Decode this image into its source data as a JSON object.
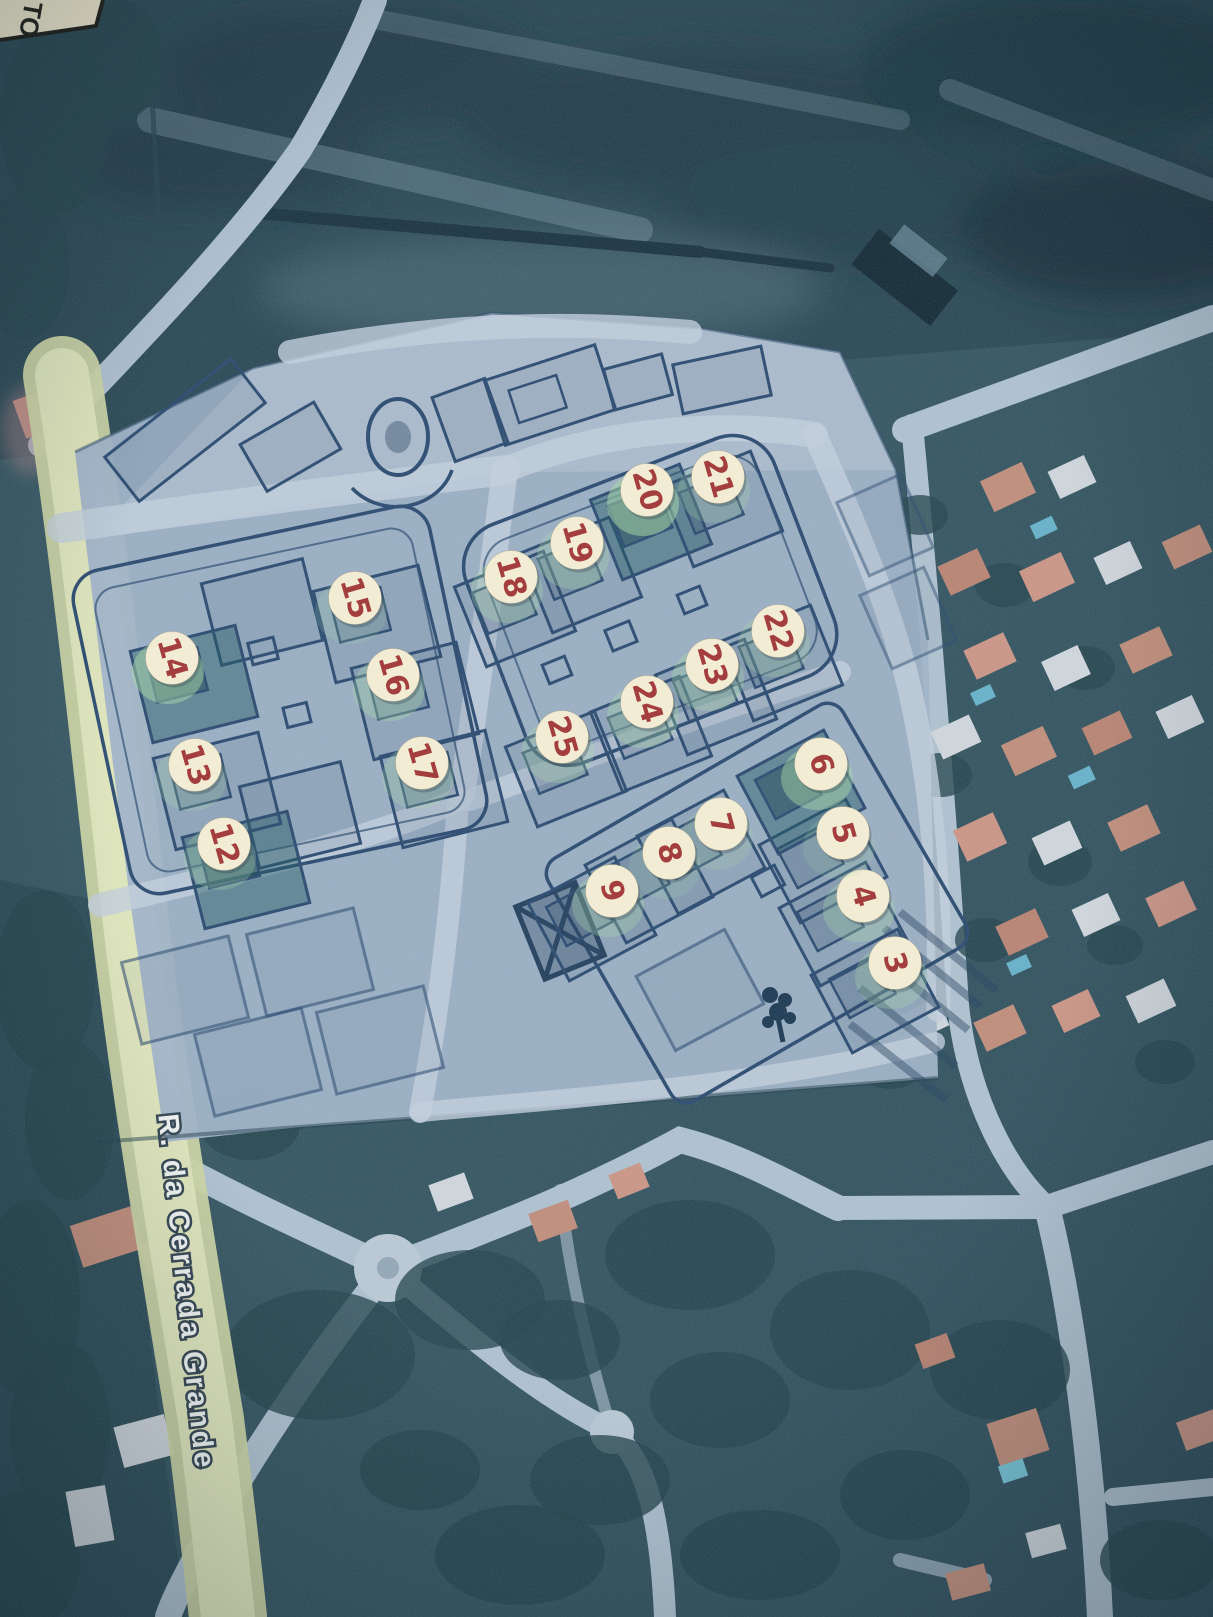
{
  "map": {
    "corner_label": {
      "text": "TO"
    },
    "street_label": {
      "text": "R. da Cerrada Grande"
    },
    "marker_style": {
      "fill": "#f4ecd2",
      "text_color": "#9e2f2f",
      "halo_color": "#a8dba4",
      "rotation_deg": 74,
      "radius": 26.5,
      "font_size": 30
    },
    "colors": {
      "satellite_base": "#2e505c",
      "field_dark": "#24434f",
      "plan_overlay": "#9cb0c5",
      "plan_line": "#24456b",
      "road_light": "#abbecc",
      "road_yellow": "#d6dcae",
      "roof_salmon": "#bd8976",
      "roof_white": "#ccd3d9",
      "pool_cyan": "#62aec6"
    },
    "markers": [
      {
        "n": "3",
        "x": 895,
        "y": 963,
        "g": "e",
        "halo": 0.5
      },
      {
        "n": "4",
        "x": 863,
        "y": 896,
        "g": "e",
        "halo": 0.55
      },
      {
        "n": "5",
        "x": 843,
        "y": 833,
        "g": "e",
        "halo": 0.3
      },
      {
        "n": "6",
        "x": 821,
        "y": 764,
        "g": "e",
        "halo": 0.8,
        "dk": true
      },
      {
        "n": "7",
        "x": 721,
        "y": 824,
        "g": "e",
        "halo": 0.35
      },
      {
        "n": "8",
        "x": 669,
        "y": 853,
        "g": "e",
        "halo": 0.3
      },
      {
        "n": "9",
        "x": 612,
        "y": 891,
        "g": "e",
        "halo": 0.55
      },
      {
        "n": "12",
        "x": 224,
        "y": 844,
        "g": "w",
        "halo": 0.45,
        "dk": true
      },
      {
        "n": "13",
        "x": 195,
        "y": 765,
        "g": "w",
        "halo": 0.4
      },
      {
        "n": "14",
        "x": 172,
        "y": 658,
        "g": "w",
        "halo": 0.85,
        "dk": true
      },
      {
        "n": "15",
        "x": 355,
        "y": 598,
        "g": "w",
        "halo": 0.3
      },
      {
        "n": "16",
        "x": 393,
        "y": 675,
        "g": "w",
        "halo": 0.6
      },
      {
        "n": "17",
        "x": 422,
        "y": 763,
        "g": "w",
        "halo": 0.45
      },
      {
        "n": "18",
        "x": 511,
        "y": 577,
        "g": "m",
        "halo": 0.5
      },
      {
        "n": "19",
        "x": 577,
        "y": 543,
        "g": "m",
        "halo": 0.55
      },
      {
        "n": "20",
        "x": 647,
        "y": 490,
        "g": "m",
        "halo": 0.9,
        "dk": true
      },
      {
        "n": "21",
        "x": 718,
        "y": 477,
        "g": "m",
        "halo": 0.4
      },
      {
        "n": "22",
        "x": 778,
        "y": 631,
        "g": "m",
        "halo": 0.45
      },
      {
        "n": "23",
        "x": 712,
        "y": 665,
        "g": "m",
        "halo": 0.6
      },
      {
        "n": "24",
        "x": 647,
        "y": 702,
        "g": "m",
        "halo": 0.6
      },
      {
        "n": "25",
        "x": 562,
        "y": 737,
        "g": "m",
        "halo": 0.5
      }
    ]
  }
}
